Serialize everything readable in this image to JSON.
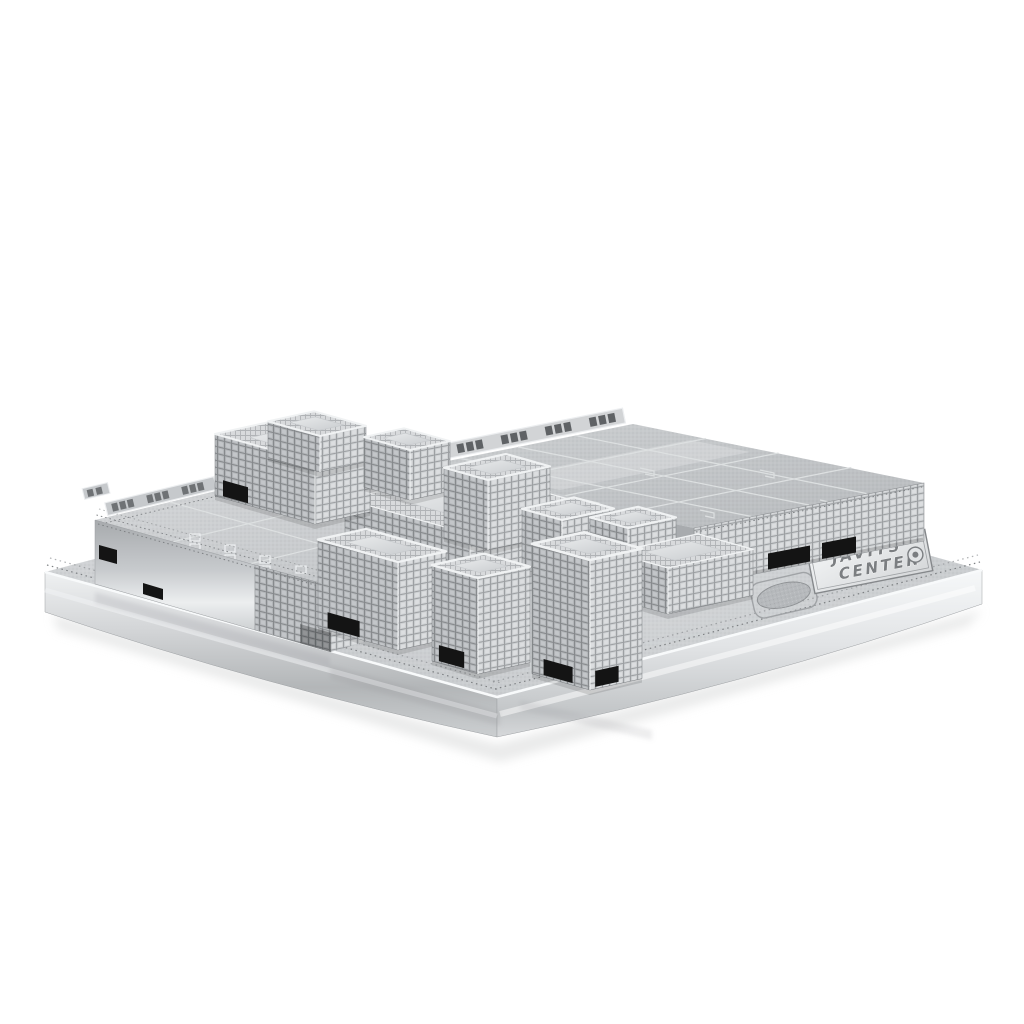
{
  "image": {
    "kind": "product-photo",
    "subject": "Silver laser-cut metal 3D model kit of the Javits Convention Center, assembled on a rectangular etched metal base, photographed at a three-quarter angle on a plain white background",
    "background_color": "#ffffff"
  },
  "nameplate": {
    "line1": "JAVITS",
    "line2": "CENTER"
  },
  "colors": {
    "metal_highlight": "#f4f6f7",
    "metal_light": "#dcdee0",
    "metal_mid": "#c2c5c8",
    "metal_dark": "#9a9da0",
    "etch_line": "#dde0e1",
    "rivet_dot": "#7d8083",
    "slot_black": "#141414"
  }
}
